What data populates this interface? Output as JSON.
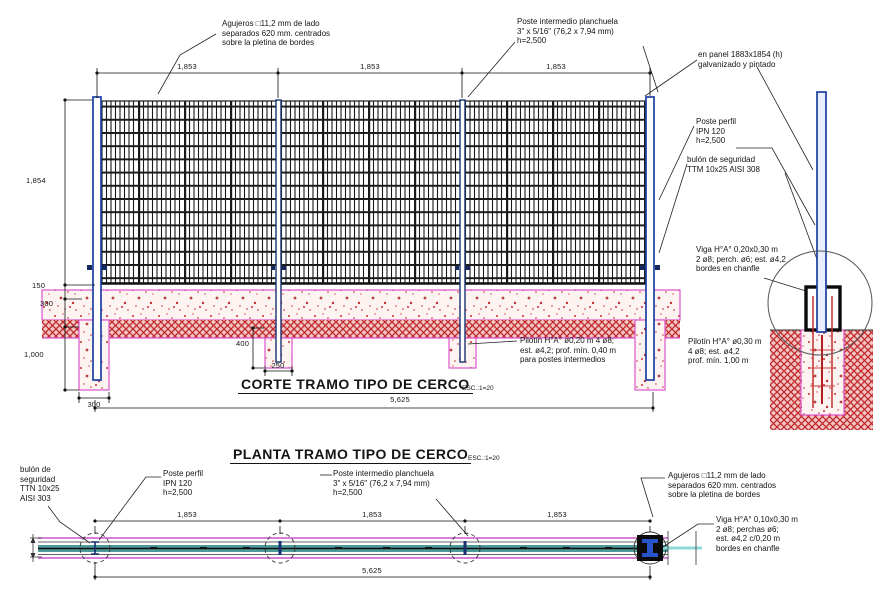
{
  "drawing_title": "Cerco - corte y planta tramo tipo",
  "colors": {
    "post_blue": "#1c3fa0",
    "intermediate_navy": "#18306f",
    "mesh_black": "#1a1a1a",
    "soil_hatch_red": "#c02828",
    "footing_magenta": "#dd55cc",
    "plan_teal": "#4e9999",
    "plan_cyan": "#8fd8d8",
    "line_black": "#141414"
  },
  "section": {
    "title": "CORTE TRAMO TIPO DE CERCO",
    "scale_note": "ESC.:1=20",
    "ann": {
      "agujeros": "Agujeros □11,2 mm de lado\nseparados 620 mm. centrados\nsobre la pletina de bordes",
      "poste_intermedio": "Poste intermedio planchuela\n3\" x 5/16\"  (76,2 x 7,94 mm)\nh=2,500",
      "panel": "en panel 1883x1854 (h)\ngalvanizado y pintado",
      "poste_perfil": "Poste perfil\nIPN 120\nh=2,500",
      "bulon": "bulón de seguridad\nTTM 10x25 AISI 308",
      "viga": "Viga H°A° 0,20x0,30 m\n2 ø8; perch. ø6; est. ø4,2\nbordes en chanfle",
      "pilotin_end": "Pilotín H°A° ø0,30 m\n4 ø8; est. ø4,2\nprof. mín. 1,00 m",
      "pilotin_mid": "Pilotín H°A° ø0,20 m 4 ø8;\nest. ø4,2; prof. mín. 0,40 m\npara postes intermedios"
    },
    "dims": {
      "spans": [
        "1,853",
        "1,853",
        "1,853"
      ],
      "panel_height": "1,854",
      "d150": "150",
      "d300": "300",
      "d1000": "1,000",
      "d400": "400",
      "d250": "250",
      "footing_width": "300",
      "total": "5,625"
    }
  },
  "plan": {
    "title": "PLANTA TRAMO TIPO DE CERCO",
    "scale_note": "ESC.:1=20",
    "ann": {
      "bulon": "bulón de\nseguridad\nTTN 10x25\nAISI 303",
      "poste_perfil": "Poste perfil\nIPN 120\nh=2,500",
      "poste_intermedio": "Poste intermedio planchuela\n3\" x 5/16\"  (76,2 x 7,94 mm)\nh=2,500",
      "agujeros": "Agujeros □11,2 mm de lado\nseparados 620 mm. centrados\nsobre la pletina de bordes",
      "viga": "Viga H°A° 0,10x0,30 m\n2 ø8; perchas ø6;\nest. ø4,2 c/0,20 m\nbordes en chanfle"
    },
    "dims": {
      "spans": [
        "1,853",
        "1,853",
        "1,853"
      ],
      "total": "5,625"
    }
  }
}
